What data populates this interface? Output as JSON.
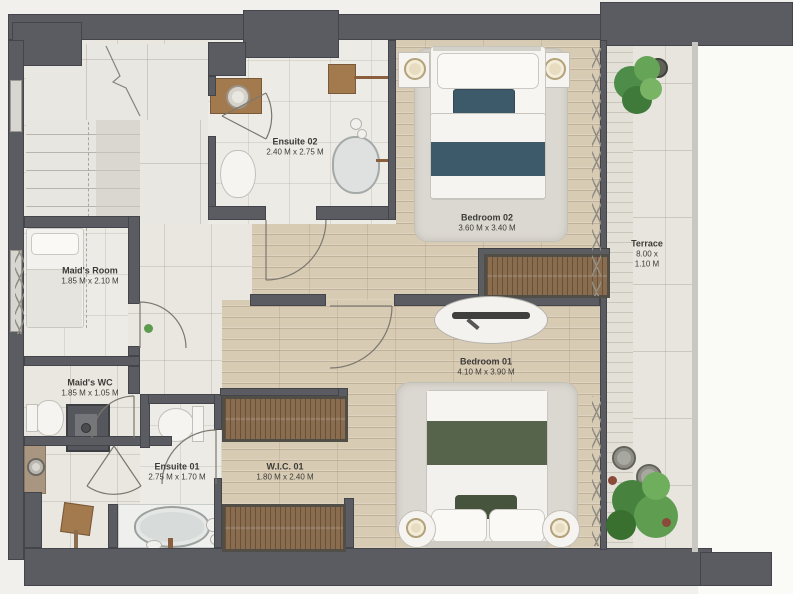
{
  "plan_title": "floor-plan",
  "rooms": {
    "maids_room": {
      "name": "Maid's Room",
      "dims": "1.85 M x 2.10 M"
    },
    "maids_wc": {
      "name": "Maid's WC",
      "dims": "1.85 M x 1.05 M"
    },
    "ensuite02": {
      "name": "Ensuite 02",
      "dims": "2.40 M x 2.75 M"
    },
    "ensuite01": {
      "name": "Ensuite 01",
      "dims": "2.75 M x 1.70 M"
    },
    "wic01": {
      "name": "W.I.C. 01",
      "dims": "1.80 M x 2.40 M"
    },
    "bedroom02": {
      "name": "Bedroom 02",
      "dims": "3.60 M x 3.40 M"
    },
    "bedroom01": {
      "name": "Bedroom 01",
      "dims": "4.10 M x 3.90 M"
    },
    "terrace": {
      "name": "Terrace",
      "dims_line1": "8.00 x",
      "dims_line2": "1.10 M"
    }
  },
  "colors": {
    "page": "#f2f0ec",
    "outside": "#fafaf7",
    "wall": "#5a5c61",
    "wood": "#d8cbb4",
    "tile": "#eae7e1",
    "tile-light": "#edebe6",
    "marble": "#eff0ee",
    "terrace-floor": "#e8e5de",
    "rug": "#dbd8d1",
    "teal": "#3d5a6a",
    "teal-dark": "#32495a",
    "green": "#55644b",
    "green-dark": "#46543d",
    "brown": "#a3794e",
    "wardrobe": "#8a6d4f",
    "plant": "#4c8a47",
    "label": "#3c3b37"
  }
}
